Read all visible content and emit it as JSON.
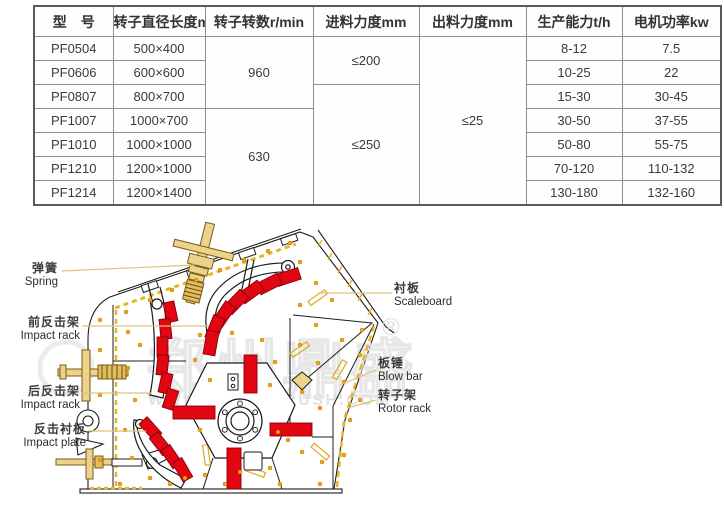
{
  "table": {
    "headers": [
      "型　号",
      "转子直径长度mm",
      "转子转数r/min",
      "进料力度mm",
      "出料力度mm",
      "生产能力t/h",
      "电机功率kw"
    ],
    "rows": [
      {
        "model": "PF0504",
        "rotor_size": "500×400",
        "capacity": "8-12",
        "power": "7.5"
      },
      {
        "model": "PF0606",
        "rotor_size": "600×600",
        "capacity": "10-25",
        "power": "22"
      },
      {
        "model": "PF0807",
        "rotor_size": "800×700",
        "capacity": "15-30",
        "power": "30-45"
      },
      {
        "model": "PF1007",
        "rotor_size": "1000×700",
        "capacity": "30-50",
        "power": "37-55"
      },
      {
        "model": "PF1010",
        "rotor_size": "1000×1000",
        "capacity": "50-80",
        "power": "55-75"
      },
      {
        "model": "PF1210",
        "rotor_size": "1200×1000",
        "capacity": "70-120",
        "power": "110-132"
      },
      {
        "model": "PF1214",
        "rotor_size": "1200×1400",
        "capacity": "130-180",
        "power": "132-160"
      }
    ],
    "merged": {
      "speed_960": "960",
      "speed_630": "630",
      "feed_200": "≤200",
      "feed_250": "≤250",
      "output_25": "≤25"
    }
  },
  "diagram": {
    "labels": {
      "spring": {
        "zh": "弹簧",
        "en": "Spring"
      },
      "front_impact_rack": {
        "zh": "前反击架",
        "en": "Impact rack"
      },
      "rear_impact_rack": {
        "zh": "后反击架",
        "en": "Impact rack"
      },
      "impact_plate": {
        "zh": "反击衬板",
        "en": "Impact plate"
      },
      "scaleboard": {
        "zh": "衬板",
        "en": "Scaleboard"
      },
      "blow_bar": {
        "zh": "板锤",
        "en": "Blow bar"
      },
      "rotor_rack": {
        "zh": "转子架",
        "en": "Rotor rack"
      }
    },
    "watermark": {
      "glyphs": "郑州鼎盛",
      "url": "WWW.CHINACRUSH.COM",
      "registered": "®"
    }
  }
}
